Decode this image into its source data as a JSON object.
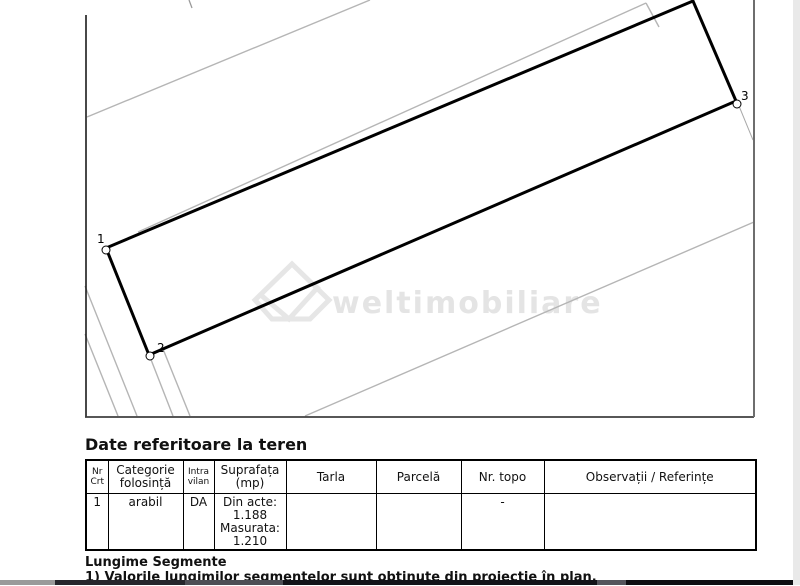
{
  "page": {
    "background": "#ffffff",
    "right_band_color": "#e9e9e9"
  },
  "plan": {
    "parcel": {
      "points": "106,248 149,355 736,101 693,1",
      "stroke": "#000000",
      "stroke_width": 3
    },
    "vertices": [
      {
        "label": "1",
        "cx": 106,
        "cy": 250,
        "lx": 97,
        "ly": 243
      },
      {
        "label": "2",
        "cx": 150,
        "cy": 356,
        "lx": 157,
        "ly": 352
      },
      {
        "label": "3",
        "cx": 737,
        "cy": 104,
        "lx": 741,
        "ly": 100
      }
    ],
    "vertex_marker": {
      "radius": 4,
      "fill": "#ffffff",
      "stroke": "#000000"
    },
    "lines": [
      {
        "name": "neighbor-boundary-upper",
        "x1": 87,
        "y1": 117,
        "x2": 370,
        "y2": 0,
        "color": "#b5b5b5",
        "width": 1.4
      },
      {
        "name": "neighbor-boundary-top",
        "x1": 138,
        "y1": 232,
        "x2": 646,
        "y2": 3,
        "color": "#b5b5b5",
        "width": 1.4
      },
      {
        "name": "neighbor-boundary-top-corner",
        "x1": 646,
        "y1": 3,
        "x2": 659,
        "y2": 27,
        "color": "#b5b5b5",
        "width": 1.4
      },
      {
        "name": "neighbor-boundary-lower",
        "x1": 305,
        "y1": 416,
        "x2": 754,
        "y2": 222,
        "color": "#b5b5b5",
        "width": 1.4
      },
      {
        "name": "side-boundary-1",
        "x1": 85,
        "y1": 334,
        "x2": 118,
        "y2": 416,
        "color": "#b5b5b5",
        "width": 1.4
      },
      {
        "name": "side-boundary-2",
        "x1": 85,
        "y1": 286,
        "x2": 137,
        "y2": 416,
        "color": "#b5b5b5",
        "width": 1.4
      },
      {
        "name": "side-boundary-3",
        "x1": 150,
        "y1": 357,
        "x2": 173,
        "y2": 416,
        "color": "#b5b5b5",
        "width": 1.4
      },
      {
        "name": "side-boundary-4",
        "x1": 163,
        "y1": 349,
        "x2": 190,
        "y2": 416,
        "color": "#b5b5b5",
        "width": 1.4
      },
      {
        "name": "vertex3-leader-line",
        "x1": 739,
        "y1": 106,
        "x2": 753,
        "y2": 140,
        "color": "#a8a8a8",
        "width": 1
      },
      {
        "name": "top-tick-mark",
        "x1": 189,
        "y1": 0,
        "x2": 192,
        "y2": 8,
        "color": "#9a9a9a",
        "width": 1.3
      },
      {
        "name": "plan-left-border",
        "x1": 86,
        "y1": 15,
        "x2": 86,
        "y2": 417,
        "color": "#1a1a1a",
        "width": 1.6
      },
      {
        "name": "plan-bottom-border",
        "x1": 85,
        "y1": 417,
        "x2": 754,
        "y2": 417,
        "color": "#3f3f3f",
        "width": 1.8
      },
      {
        "name": "plan-right-border",
        "x1": 754,
        "y1": 0,
        "x2": 754,
        "y2": 417,
        "color": "#6e6e6e",
        "width": 2
      }
    ],
    "watermark": {
      "text": "weltimobiliare",
      "color": "#e4e4e4",
      "x": 332,
      "y": 313,
      "font_size": 30
    }
  },
  "section_title": "Date referitoare la teren",
  "table": {
    "headers": [
      "Nr\nCrt",
      "Categorie\nfolosință",
      "Intra\nvilan",
      "Suprafața\n(mp)",
      "Tarla",
      "Parcelă",
      "Nr. topo",
      "Observații / Referințe"
    ],
    "row": [
      "1",
      "arabil",
      "DA",
      "Din acte:\n1.188\nMasurata:\n1.210",
      "",
      "",
      "-",
      ""
    ]
  },
  "notes": {
    "title": "Lungime Segmente",
    "footnote": "1) Valorile lungimilor segmentelor sunt obținute din proiecție în plan."
  },
  "bottom_band": {
    "segments": [
      {
        "x": 0,
        "w": 55,
        "color": "#9a9a9a"
      },
      {
        "x": 55,
        "w": 130,
        "color": "#26262c"
      },
      {
        "x": 185,
        "w": 98,
        "color": "#4e4e55"
      },
      {
        "x": 283,
        "w": 314,
        "color": "#131318"
      },
      {
        "x": 597,
        "w": 29,
        "color": "#55555c"
      },
      {
        "x": 626,
        "w": 167,
        "color": "#0e0e12"
      }
    ]
  }
}
